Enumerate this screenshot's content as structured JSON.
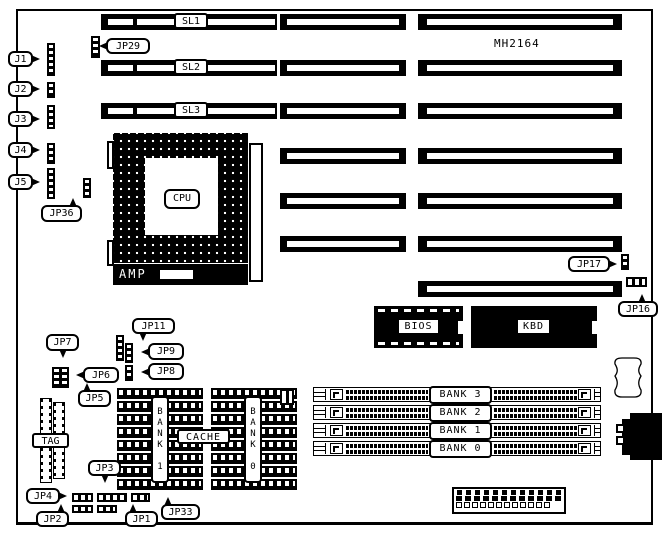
{
  "board": {
    "model": "MH2164"
  },
  "slots": {
    "sl1": "SL1",
    "sl2": "SL2",
    "sl3": "SL3"
  },
  "cpu": {
    "label": "CPU",
    "amp_label": "AMP"
  },
  "chips": {
    "bios": "BIOS",
    "kbd": "KBD"
  },
  "cache": {
    "label": "CACHE",
    "bank1": "BANK 1",
    "bank0": "BANK 0",
    "tag": "TAG"
  },
  "memory_banks": [
    "BANK 3",
    "BANK 2",
    "BANK 1",
    "BANK 0"
  ],
  "jumpers": {
    "j1": "J1",
    "j2": "J2",
    "j3": "J3",
    "j4": "J4",
    "j5": "J5",
    "jp1": "JP1",
    "jp2": "JP2",
    "jp3": "JP3",
    "jp4": "JP4",
    "jp5": "JP5",
    "jp6": "JP6",
    "jp7": "JP7",
    "jp8": "JP8",
    "jp9": "JP9",
    "jp11": "JP11",
    "jp16": "JP16",
    "jp17": "JP17",
    "jp29": "JP29",
    "jp33": "JP33",
    "jp36": "JP36"
  }
}
